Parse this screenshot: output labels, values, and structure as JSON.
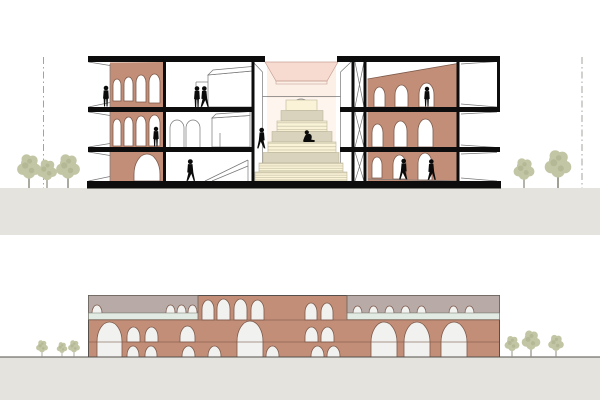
{
  "colors": {
    "background": "#ffffff",
    "ground": "#e4e3dd",
    "slab": "#0d0d0d",
    "thinLine": "#777777",
    "terracotta": "#c38e77",
    "terracottaEdge": "#7d5a4b",
    "archWhite": "#ffffff",
    "archLight": "#f1f1ef",
    "grayBand": "#b8aba7",
    "greenRibbon": "#e1ebe4",
    "skylightPink": "#f7dbd1",
    "glowPink": "#fcefe6",
    "glowPale": "#fdf5ee",
    "stairCream": "#faf3d7",
    "stairTan": "#d9d3bd",
    "stairLine": "#bcb69c",
    "figure": "#0a0a0a",
    "tree": "#c3c6a4",
    "treeDark": "#a9ad8a",
    "trunk": "#8e8e80",
    "datumLine": "#a3a39b",
    "groundLine": "#55504b"
  },
  "section": {
    "arches": {
      "leftTop": [
        {
          "x": 113,
          "w": 8,
          "t": 79,
          "b": 101
        },
        {
          "x": 124,
          "w": 9,
          "t": 77,
          "b": 101
        },
        {
          "x": 136,
          "w": 10,
          "t": 75,
          "b": 102
        },
        {
          "x": 149,
          "w": 11,
          "t": 74,
          "b": 103
        }
      ],
      "leftMid": [
        {
          "x": 113,
          "w": 8,
          "t": 119,
          "b": 146
        },
        {
          "x": 124,
          "w": 9,
          "t": 117,
          "b": 146
        },
        {
          "x": 136,
          "w": 10,
          "t": 116,
          "b": 146
        },
        {
          "x": 149,
          "w": 11,
          "t": 115,
          "b": 146
        }
      ],
      "leftGround": [
        {
          "x": 134,
          "w": 26,
          "t": 154,
          "b": 181
        }
      ],
      "rightTop": [
        {
          "x": 374,
          "w": 11,
          "t": 87,
          "b": 107
        },
        {
          "x": 395,
          "w": 13,
          "t": 85,
          "b": 107
        },
        {
          "x": 419,
          "w": 15,
          "t": 83,
          "b": 107
        }
      ],
      "rightMid": [
        {
          "x": 372,
          "w": 11,
          "t": 124,
          "b": 147
        },
        {
          "x": 394,
          "w": 13,
          "t": 121,
          "b": 147
        },
        {
          "x": 418,
          "w": 15,
          "t": 119,
          "b": 147
        }
      ],
      "rightGround": [
        {
          "x": 372,
          "w": 10,
          "t": 157,
          "b": 178
        },
        {
          "x": 393,
          "w": 13,
          "t": 155,
          "b": 179
        },
        {
          "x": 418,
          "w": 14,
          "t": 153,
          "b": 180
        }
      ]
    },
    "people": [
      {
        "type": "stand",
        "x": 106,
        "y": 106.5,
        "h": 21
      },
      {
        "type": "stand",
        "x": 197,
        "y": 107,
        "h": 21
      },
      {
        "type": "walk",
        "x": 204,
        "y": 107,
        "h": 21
      },
      {
        "type": "stand",
        "x": 156,
        "y": 146.5,
        "h": 20
      },
      {
        "type": "walk",
        "x": 262,
        "y": 148.5,
        "h": 21,
        "flip": true
      },
      {
        "type": "sit",
        "x": 309,
        "y": 142,
        "h": 20
      },
      {
        "type": "walk",
        "x": 190,
        "y": 181,
        "h": 22
      },
      {
        "type": "stand",
        "x": 427,
        "y": 106.5,
        "h": 20
      },
      {
        "type": "walk",
        "x": 404,
        "y": 179.5,
        "h": 21,
        "flip": true
      },
      {
        "type": "walk",
        "x": 431,
        "y": 180,
        "h": 21
      }
    ],
    "treesLeft": [
      {
        "x": 29,
        "y": 188,
        "s": 1.25
      },
      {
        "x": 47,
        "y": 188,
        "s": 1.05
      },
      {
        "x": 68,
        "y": 188,
        "s": 1.25
      }
    ],
    "treesRight": [
      {
        "x": 524,
        "y": 188,
        "s": 1.1
      },
      {
        "x": 558,
        "y": 188,
        "s": 1.4
      }
    ]
  },
  "elevation": {
    "arches": {
      "big": [
        {
          "x": 97,
          "w": 25,
          "t": 322,
          "b": 357
        },
        {
          "x": 237,
          "w": 26,
          "t": 321,
          "b": 357
        },
        {
          "x": 371,
          "w": 26,
          "t": 322,
          "b": 357
        },
        {
          "x": 404,
          "w": 26,
          "t": 322,
          "b": 357
        },
        {
          "x": 441,
          "w": 26,
          "t": 322,
          "b": 357
        }
      ],
      "mid": [
        {
          "x": 127,
          "w": 13,
          "t": 327,
          "b": 342
        },
        {
          "x": 145,
          "w": 13,
          "t": 327,
          "b": 342
        },
        {
          "x": 180,
          "w": 15,
          "t": 326,
          "b": 342
        },
        {
          "x": 305,
          "w": 13,
          "t": 327,
          "b": 342
        },
        {
          "x": 321,
          "w": 13,
          "t": 327,
          "b": 342
        }
      ],
      "bottom": [
        {
          "x": 127,
          "w": 12,
          "t": 346,
          "b": 357
        },
        {
          "x": 145,
          "w": 12,
          "t": 346,
          "b": 357
        },
        {
          "x": 182,
          "w": 13,
          "t": 346,
          "b": 357
        },
        {
          "x": 208,
          "w": 13,
          "t": 346,
          "b": 357
        },
        {
          "x": 266,
          "w": 13,
          "t": 346,
          "b": 357
        },
        {
          "x": 311,
          "w": 13,
          "t": 346,
          "b": 357
        },
        {
          "x": 327,
          "w": 13,
          "t": 346,
          "b": 357
        }
      ],
      "topCenter": [
        {
          "x": 202,
          "w": 12,
          "t": 300,
          "b": 320
        },
        {
          "x": 217,
          "w": 13,
          "t": 299,
          "b": 320
        },
        {
          "x": 234,
          "w": 13,
          "t": 299,
          "b": 320
        },
        {
          "x": 251,
          "w": 13,
          "t": 300,
          "b": 320
        },
        {
          "x": 305,
          "w": 12,
          "t": 303,
          "b": 320
        },
        {
          "x": 321,
          "w": 12,
          "t": 303,
          "b": 320
        }
      ],
      "clerestoryLeft": [
        {
          "x": 92,
          "w": 10,
          "t": 305,
          "b": 313.4
        },
        {
          "x": 166,
          "w": 9,
          "t": 305,
          "b": 313.4
        },
        {
          "x": 177,
          "w": 9,
          "t": 305,
          "b": 313.4
        },
        {
          "x": 188,
          "w": 9,
          "t": 305,
          "b": 313.4
        }
      ],
      "clerestoryRight": [
        {
          "x": 353,
          "w": 9,
          "t": 306,
          "b": 313.4
        },
        {
          "x": 369,
          "w": 9,
          "t": 306,
          "b": 313.4
        },
        {
          "x": 385,
          "w": 9,
          "t": 306,
          "b": 313.4
        },
        {
          "x": 401,
          "w": 9,
          "t": 306,
          "b": 313.4
        },
        {
          "x": 417,
          "w": 9,
          "t": 306,
          "b": 313.4
        },
        {
          "x": 449,
          "w": 9,
          "t": 306,
          "b": 313.4
        },
        {
          "x": 465,
          "w": 9,
          "t": 306,
          "b": 313.4
        }
      ]
    },
    "treesLeft": [
      {
        "x": 42,
        "y": 357,
        "s": 0.62
      },
      {
        "x": 62,
        "y": 357,
        "s": 0.55
      },
      {
        "x": 74,
        "y": 357,
        "s": 0.62
      }
    ],
    "treesRight": [
      {
        "x": 512,
        "y": 357,
        "s": 0.78
      },
      {
        "x": 531,
        "y": 357,
        "s": 0.98
      },
      {
        "x": 556,
        "y": 357,
        "s": 0.82
      }
    ]
  }
}
